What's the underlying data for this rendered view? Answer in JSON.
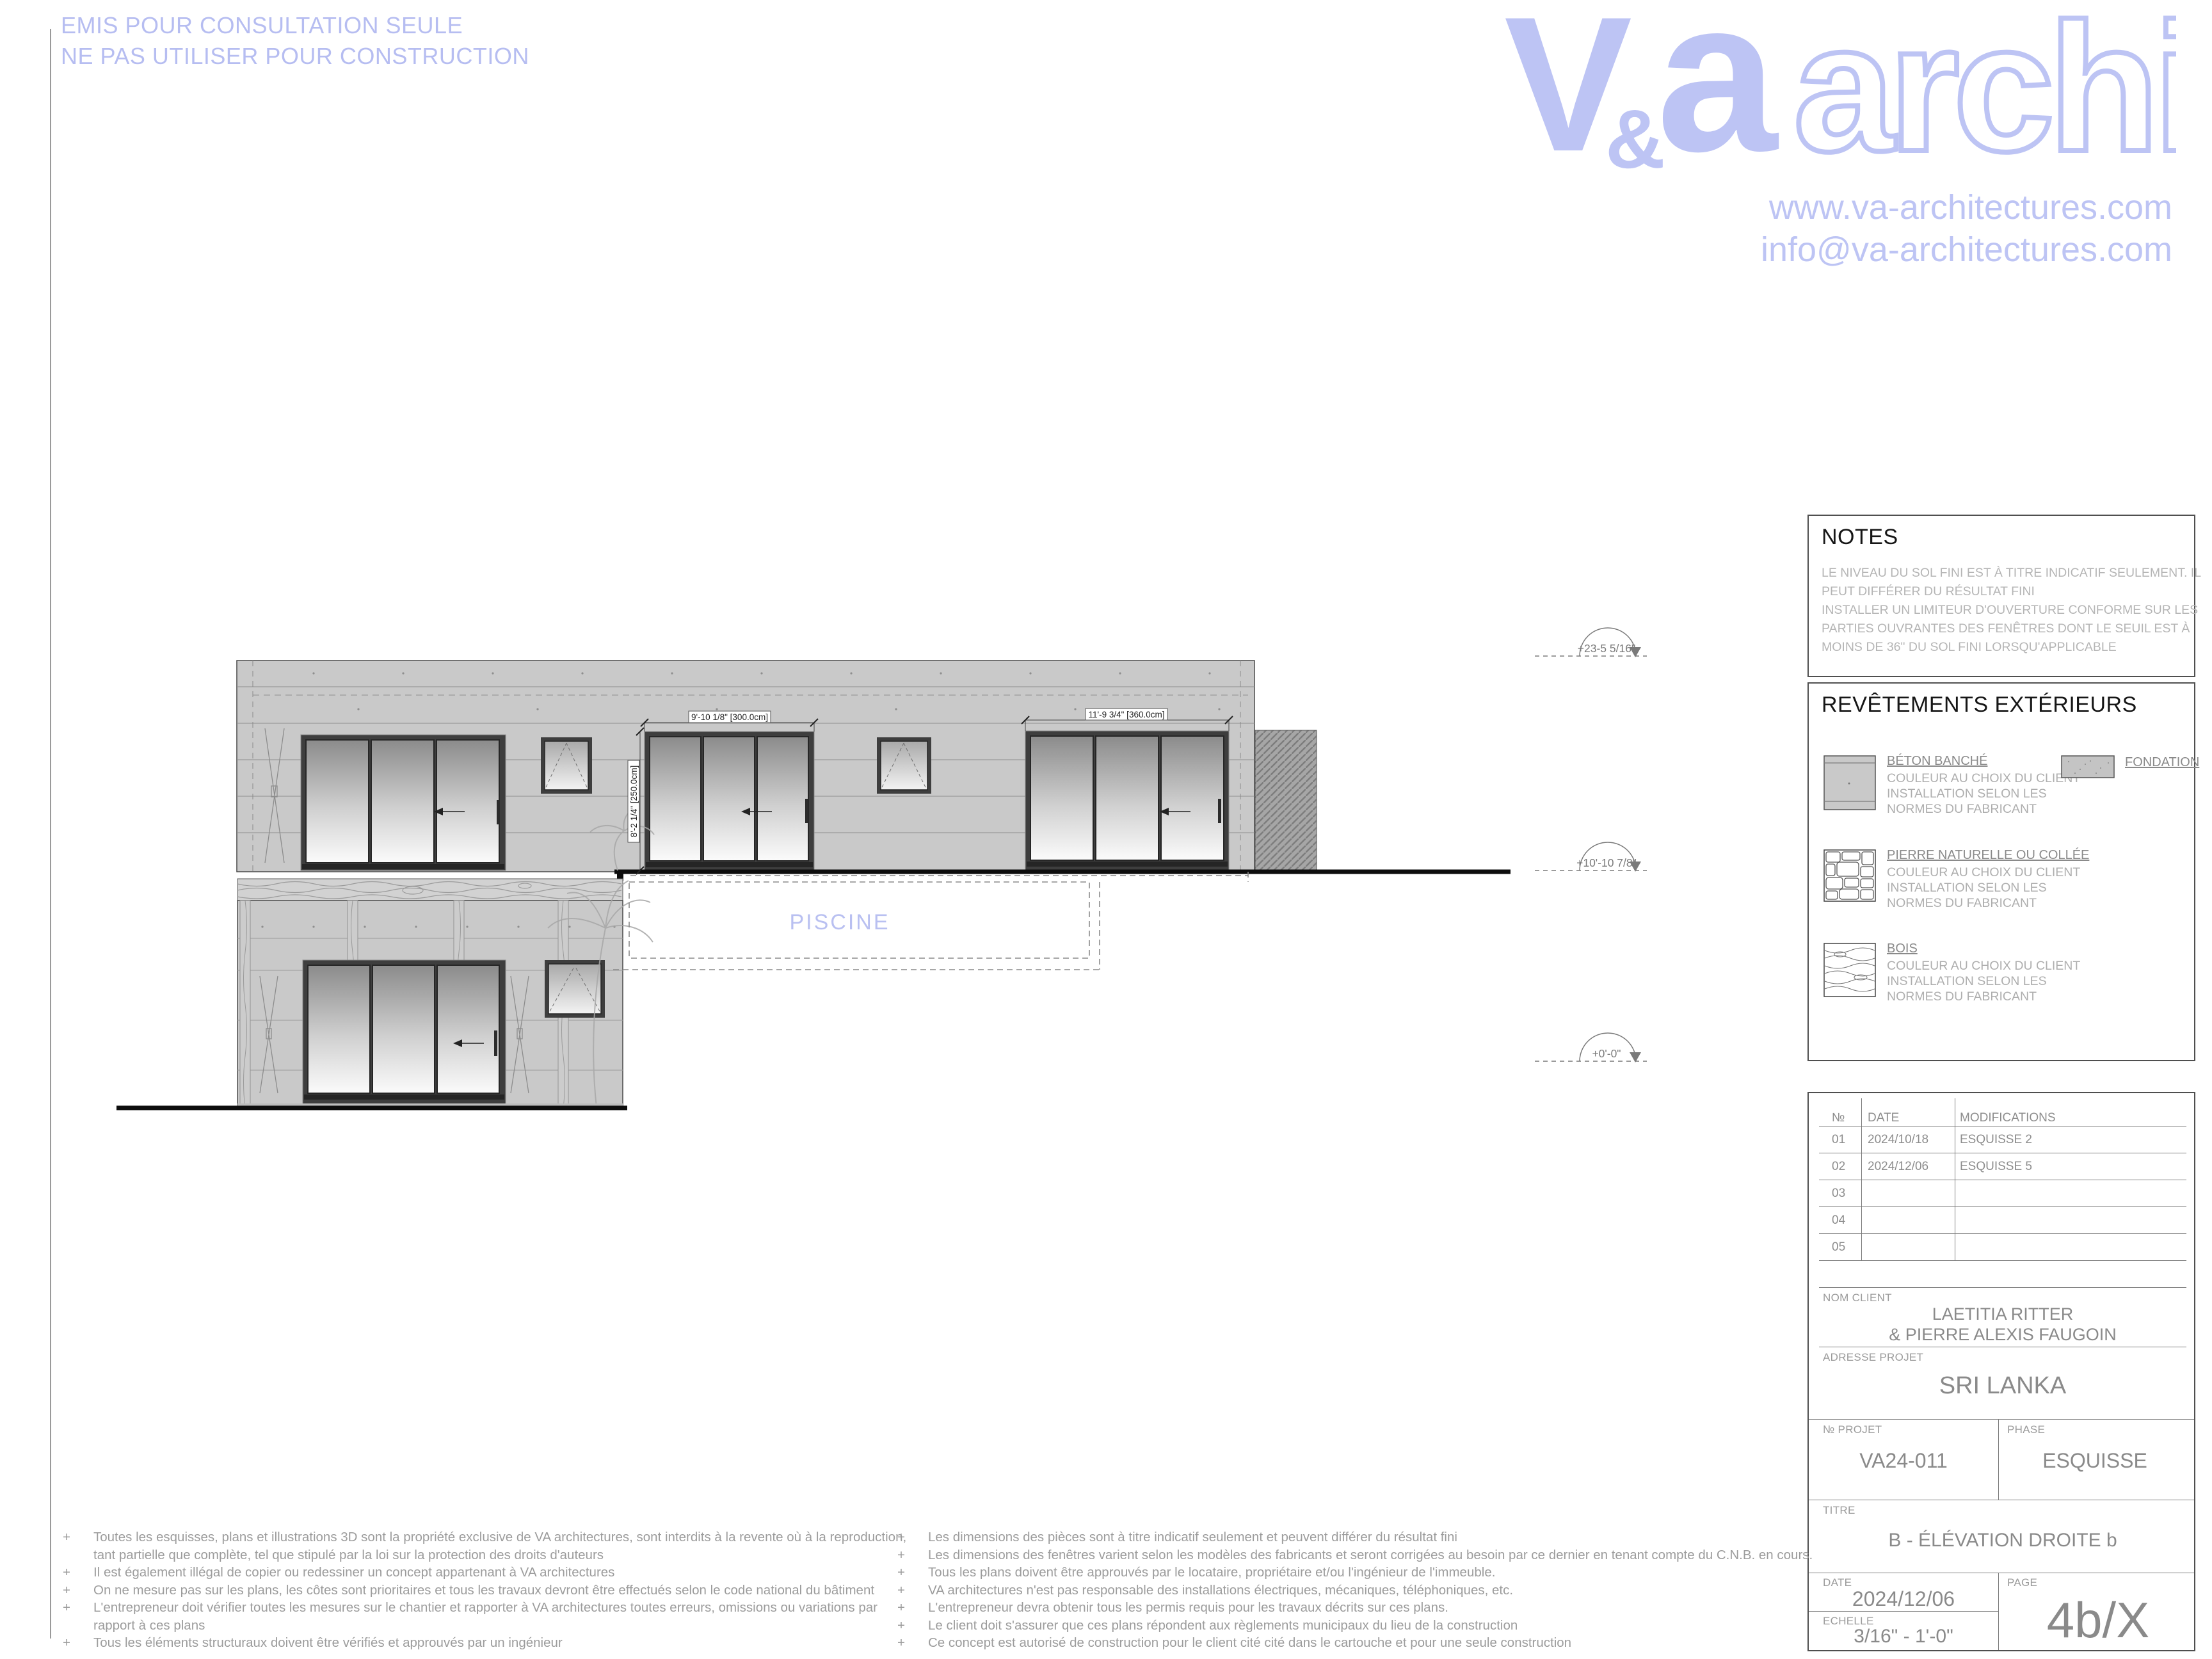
{
  "page": {
    "stamp_line1": "EMIS POUR CONSULTATION SEULE",
    "stamp_line2": "NE PAS UTILISER POUR CONSTRUCTION"
  },
  "brand": {
    "logo_v": "V",
    "logo_amp": "&",
    "logo_a": "a",
    "logo_outline": "archi",
    "website": "www.va-architectures.com",
    "email": "info@va-architectures.com",
    "accent_color": "#bdc4f4"
  },
  "notes": {
    "title": "NOTES",
    "lines": [
      "LE NIVEAU DU SOL FINI EST À TITRE INDICATIF SEULEMENT. IL",
      "PEUT DIFFÉRER DU RÉSULTAT FINI",
      "INSTALLER UN LIMITEUR D'OUVERTURE CONFORME SUR LES",
      "PARTIES OUVRANTES DES FENÊTRES DONT LE SEUIL EST À",
      "MOINS DE 36\" DU SOL FINI LORSQU'APPLICABLE"
    ]
  },
  "materials": {
    "title": "REVÊTEMENTS EXTÉRIEURS",
    "fondation_label": "FONDATION",
    "items": [
      {
        "name": "BÉTON BANCHÉ",
        "desc": [
          "COULEUR AU CHOIX DU CLIENT",
          "INSTALLATION SELON LES",
          "NORMES DU FABRICANT"
        ]
      },
      {
        "name": "PIERRE NATURELLE OU COLLÉE",
        "desc": [
          "COULEUR AU CHOIX DU CLIENT",
          "INSTALLATION SELON LES",
          "NORMES DU FABRICANT"
        ]
      },
      {
        "name": "BOIS",
        "desc": [
          "COULEUR AU CHOIX DU CLIENT",
          "INSTALLATION SELON LES",
          "NORMES DU FABRICANT"
        ]
      }
    ]
  },
  "elevation": {
    "pool_label": "PISCINE",
    "levels": [
      {
        "label": "+23-5 5/16\""
      },
      {
        "label": "+10'-10 7/8\""
      },
      {
        "label": "+0'-0\""
      }
    ],
    "dimensions": {
      "door_center_width": "9'-10 1/8\" [300.0cm]",
      "door_right_width": "11'-9 3/4\" [360.0cm]",
      "door_height": "8'-2 1/4\" [250.0cm]"
    }
  },
  "titleblock": {
    "rev": {
      "col_no": "№",
      "col_date": "DATE",
      "col_mod": "MODIFICATIONS",
      "rows": [
        {
          "no": "01",
          "date": "2024/10/18",
          "mod": "ESQUISSE 2"
        },
        {
          "no": "02",
          "date": "2024/12/06",
          "mod": "ESQUISSE 5"
        },
        {
          "no": "03",
          "date": "",
          "mod": ""
        },
        {
          "no": "04",
          "date": "",
          "mod": ""
        },
        {
          "no": "05",
          "date": "",
          "mod": ""
        }
      ]
    },
    "labels": {
      "client": "NOM CLIENT",
      "address": "ADRESSE PROJET",
      "project": "№ PROJET",
      "phase": "PHASE",
      "title": "TITRE",
      "date": "DATE",
      "scale": "ECHELLE",
      "page": "PAGE"
    },
    "client_line1": "LAETITIA RITTER",
    "client_line2": "& PIERRE ALEXIS FAUGOIN",
    "address": "SRI LANKA",
    "project_no": "VA24-011",
    "phase": "ESQUISSE",
    "title": "B - ÉLÉVATION DROITE b",
    "date": "2024/12/06",
    "scale": "3/16\" - 1'-0\"",
    "page": "4b/X"
  },
  "disclaimers": {
    "bullet": "+",
    "left": [
      "Toutes les esquisses, plans et illustrations 3D sont la propriété exclusive de VA architectures, sont interdits à la revente où à la reproduction, tant partielle que complète, tel que stipulé par la loi sur la protection des droits d'auteurs",
      "Il est également illégal de copier ou redessiner un concept appartenant à VA architectures",
      "On ne mesure pas sur les plans, les côtes sont prioritaires et tous les travaux devront être effectués selon le code national du bâtiment",
      "L'entrepreneur doit vérifier toutes les mesures sur le chantier et rapporter à VA architectures toutes erreurs, omissions ou variations par rapport à ces plans",
      "Tous les éléments structuraux doivent être vérifiés et approuvés par un ingénieur"
    ],
    "right": [
      "Les dimensions des pièces sont à titre indicatif seulement et peuvent différer du résultat fini",
      "Les dimensions des fenêtres varient selon les modèles des fabricants et seront corrigées au besoin par ce dernier en tenant compte du C.N.B. en cours.",
      "Tous les plans doivent être approuvés par le locataire, propriétaire et/ou l'ingénieur de l'immeuble.",
      "VA architectures n'est pas responsable des installations électriques, mécaniques, téléphoniques, etc.",
      "L'entrepreneur devra obtenir tous les permis requis pour les travaux décrits sur ces plans.",
      "Le client doit s'assurer que ces plans répondent aux règlements municipaux du lieu de la construction",
      "Ce concept est autorisé de construction pour le client cité cité dans le cartouche et pour une seule construction"
    ]
  }
}
